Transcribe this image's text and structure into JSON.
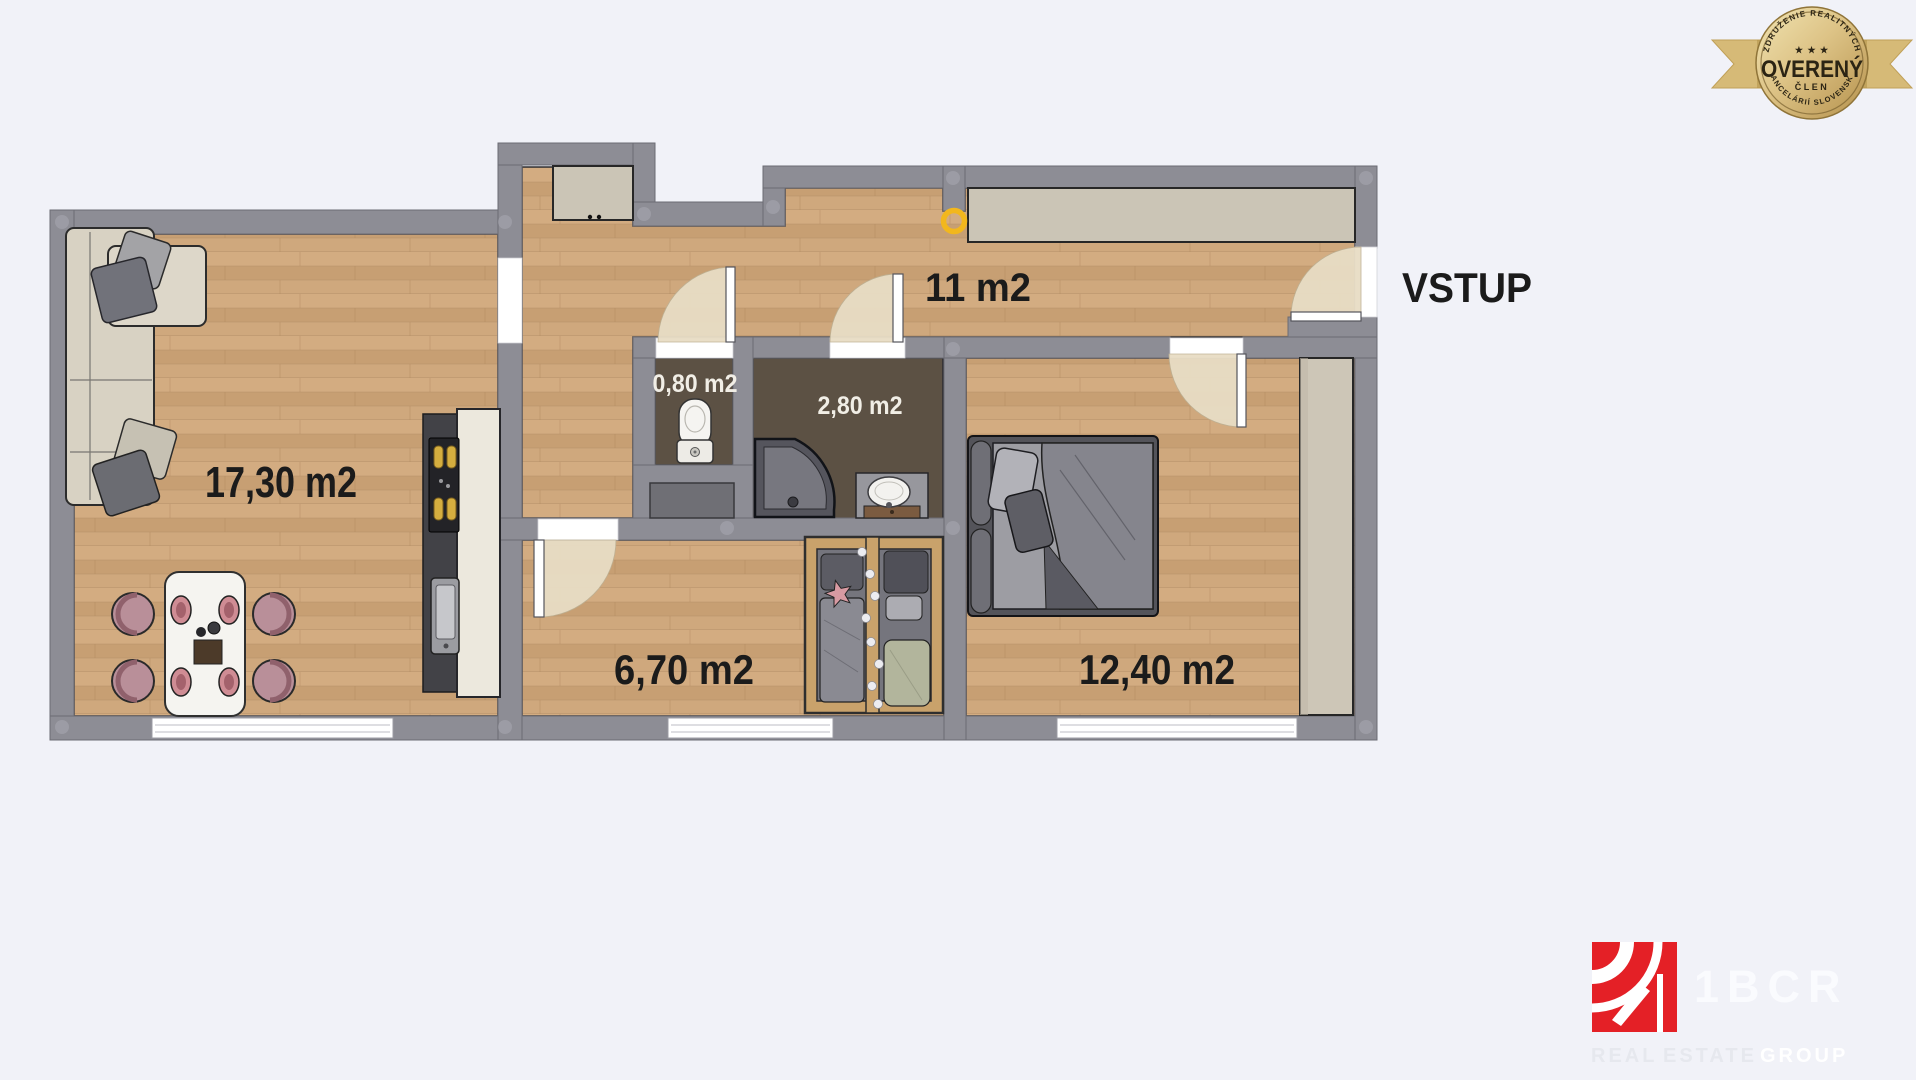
{
  "floorplan": {
    "rooms": [
      {
        "id": "living-dining",
        "area_label": "17,30 m2"
      },
      {
        "id": "hallway",
        "area_label": "11 m2"
      },
      {
        "id": "wc",
        "area_label": "0,80 m2"
      },
      {
        "id": "bathroom",
        "area_label": "2,80 m2"
      },
      {
        "id": "kids-room",
        "area_label": "6,70 m2"
      },
      {
        "id": "bedroom",
        "area_label": "12,40 m2"
      }
    ],
    "entrance_label": "VSTUP"
  },
  "badge": {
    "arc_top": "ZDRUŽENIE REALITNÝCH",
    "stars": "★ ★ ★",
    "title": "OVERENÝ",
    "member": "ČLEN",
    "arc_bottom": "KANCELÁRIÍ SLOVENSKA"
  },
  "logo": {
    "brand": "1BCR",
    "tagline": [
      "REAL",
      "ESTATE",
      "GROUP"
    ]
  },
  "colors": {
    "background": "#f1f2f8",
    "wall": "#8d8d95",
    "floor_wood": "#cda77c",
    "floor_dark": "#5c5144",
    "accent_ring": "#f2b71d",
    "brand_red": "#e42026",
    "badge_gold": "#d9bf7d"
  }
}
